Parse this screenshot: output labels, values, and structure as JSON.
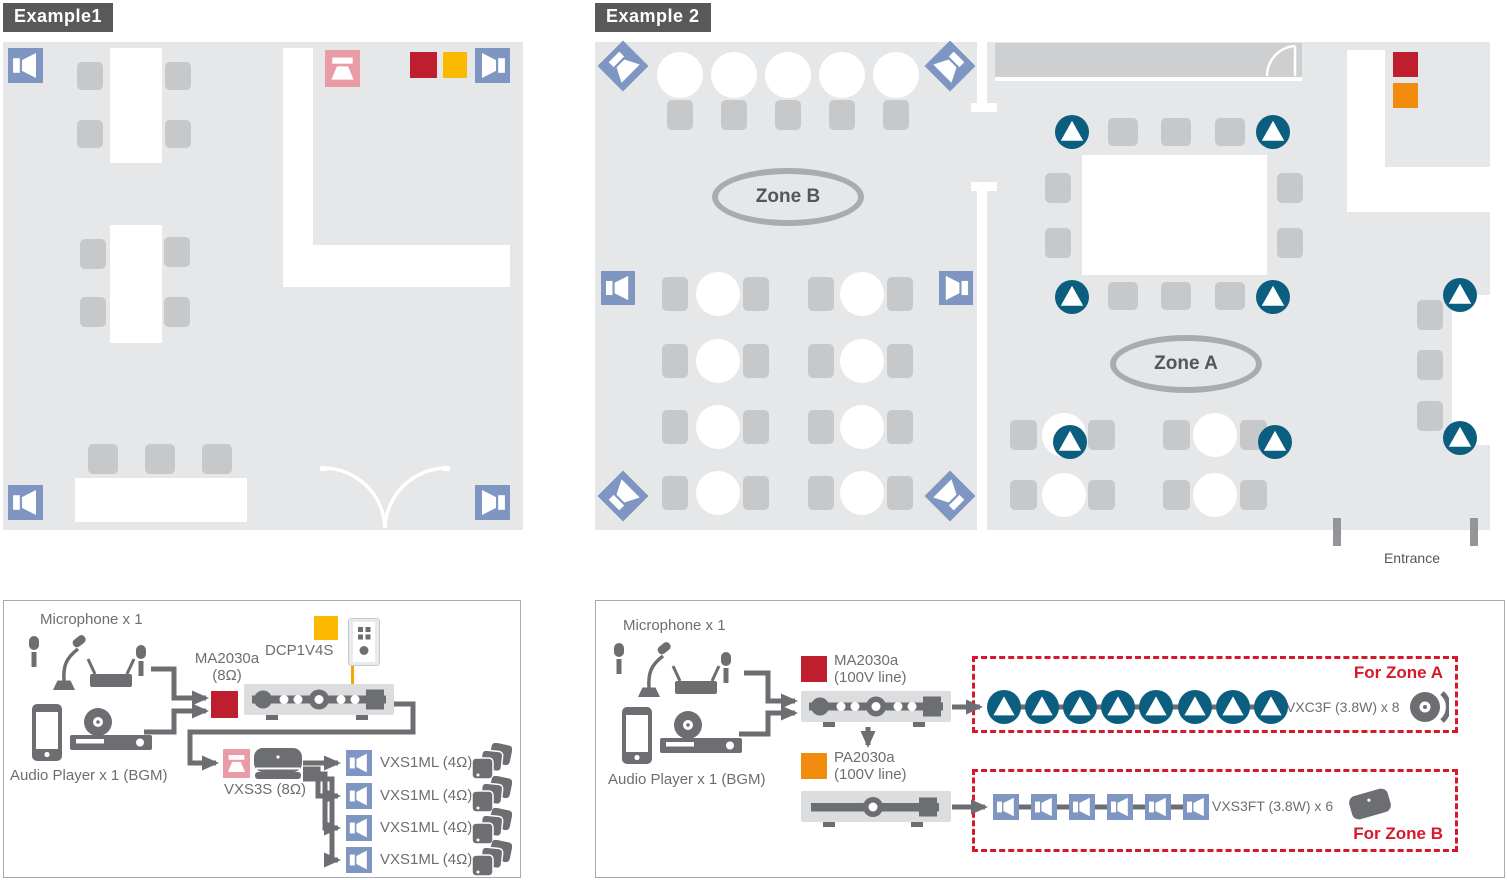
{
  "example1": {
    "tag": "Example1",
    "plan": {
      "wall_speaker_count": 4
    },
    "system": {
      "microphones_label": "Microphone x 1",
      "audio_player_label": "Audio Player x 1 (BGM)",
      "amplifier_model": "MA2030a",
      "amplifier_spec": "(8Ω)",
      "wall_controller_model": "DCP1V4S",
      "subwoofer_model": "VXS3S (8Ω)",
      "speaker_rows": [
        "VXS1ML (4Ω)",
        "VXS1ML (4Ω)",
        "VXS1ML (4Ω)",
        "VXS1ML (4Ω)"
      ]
    }
  },
  "example2": {
    "tag": "Example 2",
    "zone_a_label": "Zone A",
    "zone_b_label": "Zone B",
    "entrance_label": "Entrance",
    "plan": {
      "corner_speaker_count": 4,
      "wall_speaker_count": 2,
      "ceiling_speaker_count": 8
    },
    "system": {
      "microphones_label": "Microphone x 1",
      "audio_player_label": "Audio Player x 1 (BGM)",
      "amplifier1_model": "MA2030a",
      "amplifier1_spec": "(100V line)",
      "amplifier2_model": "PA2030a",
      "amplifier2_spec": "(100V line)",
      "zone_a_group_label": "For Zone A",
      "zone_a_speaker_label": "VXC3F (3.8W) x 8",
      "zone_a_speaker_count": 8,
      "zone_b_group_label": "For Zone B",
      "zone_b_speaker_label": "VXS3FT (3.8W) x 6",
      "zone_b_speaker_count": 6
    }
  },
  "colors": {
    "room_fill": "#E6E7E8",
    "furniture_gray": "#C6C8CA",
    "wall_speaker_blue": "#7E96C1",
    "ceiling_speaker_teal": "#0B5E80",
    "amplifier_red": "#BE1E2D",
    "amplifier_orange": "#F28C0F",
    "controller_yellow": "#FBBA00",
    "controller_cable_yellow": "#F7A800",
    "subwoofer_pink": "#E99CA5",
    "diagram_ink": "#6D6E71",
    "zone_border_red": "#D7182A",
    "label_chip_gray": "#58595B"
  },
  "icons": {
    "wall_speaker": "wall-speaker-icon",
    "corner_speaker": "corner-speaker-icon",
    "ceiling_speaker": "ceiling-speaker-icon",
    "subwoofer": "subwoofer-icon",
    "microphones": "microphone-set-icon",
    "audio_players": "audio-player-set-icon",
    "mixer_amplifier": "mixer-amplifier-icon",
    "power_amplifier": "power-amplifier-icon",
    "wall_controller": "wall-controller-icon",
    "speaker_stack": "speaker-stack-icon",
    "ceiling_speaker_product": "ceiling-speaker-product-icon",
    "surface_speaker_product": "surface-speaker-product-icon",
    "door": "door-icon"
  }
}
